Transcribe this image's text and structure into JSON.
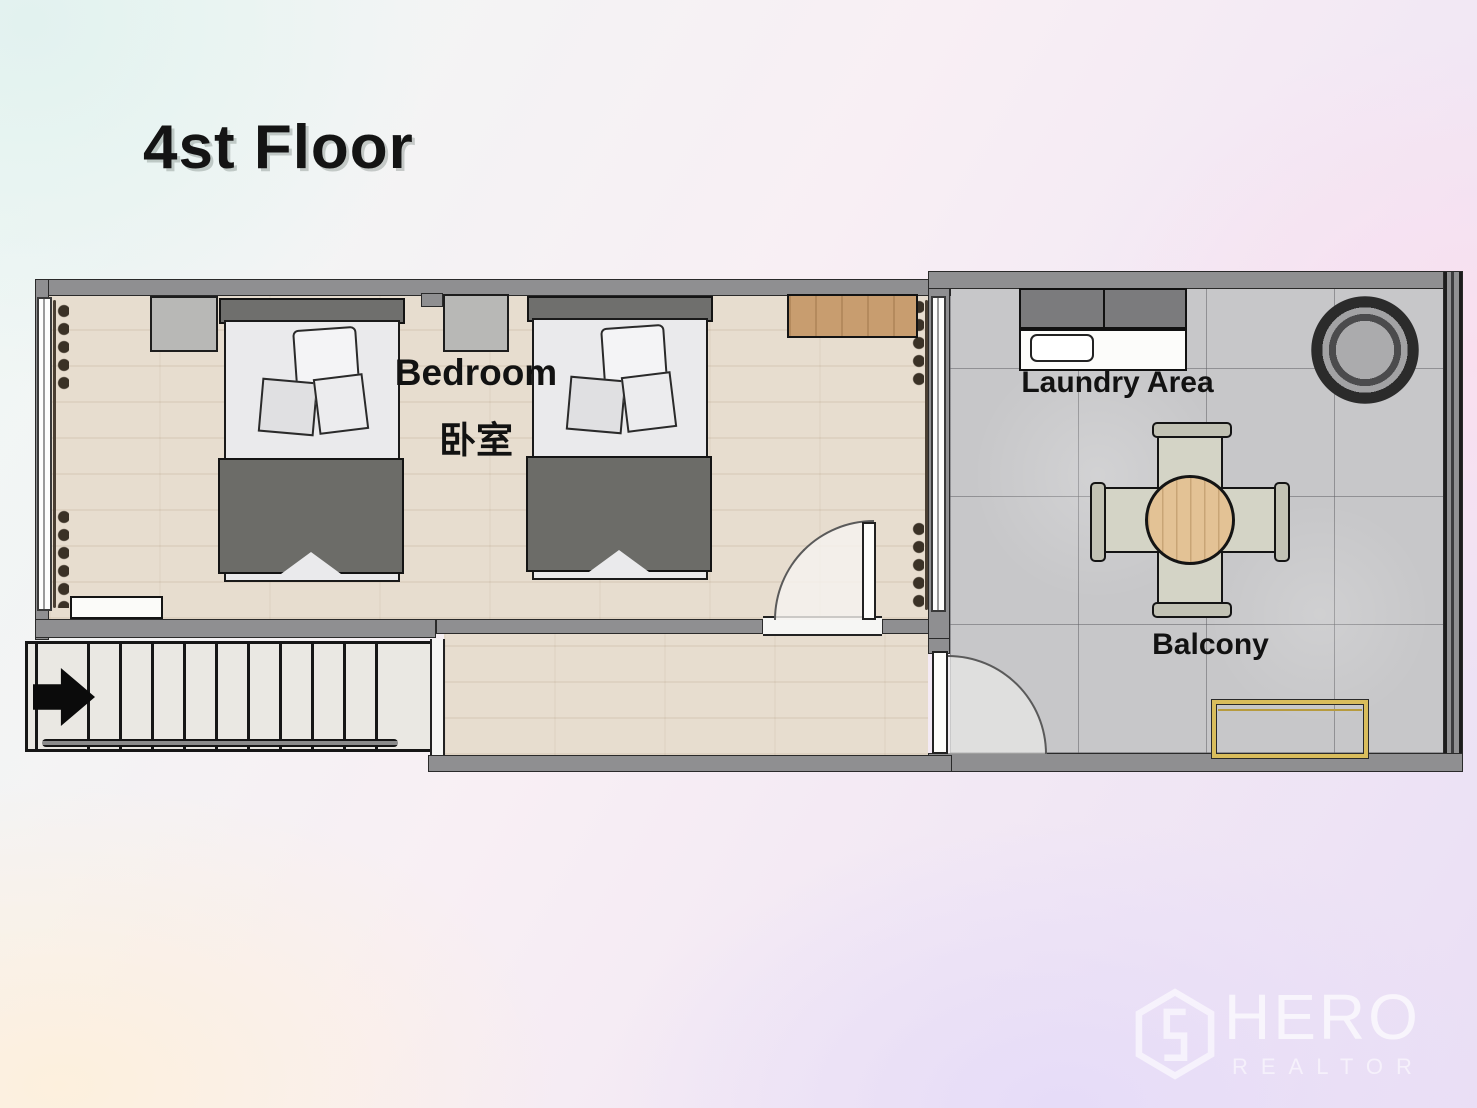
{
  "title": "4st Floor",
  "rooms": {
    "bedroom": {
      "label_en": "Bedroom",
      "label_zh": "卧室"
    },
    "laundry": {
      "label": "Laundry Area"
    },
    "balcony": {
      "label": "Balcony"
    }
  },
  "watermark": {
    "brand": "HERO",
    "tagline": "REALTOR"
  },
  "icons": [
    "stairs-direction-arrow",
    "hero-hexagon-logo"
  ],
  "colors": {
    "wall": "#8f8f91",
    "wood_floor": "#e7ddcf",
    "tile_floor": "#c7c7c9",
    "bed_blanket": "#6c6c68",
    "bed_headboard": "#6f6f6d",
    "desk_wood": "#c89d6f",
    "table_wood": "#e3c295",
    "bench_gold": "#d9bd5c",
    "arrow": "#0b0b0b"
  }
}
